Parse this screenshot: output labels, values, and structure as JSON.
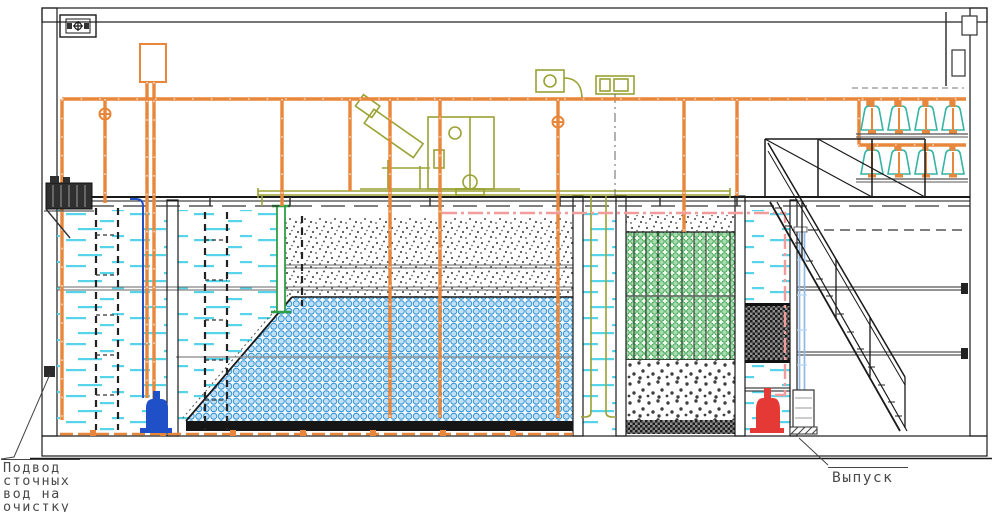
{
  "labels": {
    "inlet_line1": "Подвод",
    "inlet_line2": "сточных",
    "inlet_line3": "вод на",
    "inlet_line4": "очистку",
    "outlet": "Выпуск"
  },
  "colors": {
    "pipe_orange": "#e8873b",
    "equipment_olive": "#9aa233",
    "water_cyan": "#55d4ea",
    "media_blue_stroke": "#2d8fd0",
    "media_blue_fill": "#bfe0f7",
    "media_green": "#2f9e44",
    "media_green_fill": "#a9dcb0",
    "diffuser_teal": "#35b3a5",
    "pump_red": "#e53935",
    "pump_blue": "#2050c8",
    "pipe_pink": "#f29b9b",
    "pipe_lightblue": "#90b8e6",
    "line_black": "#1a1a1a",
    "hatch_gray": "#6f6f6f"
  }
}
